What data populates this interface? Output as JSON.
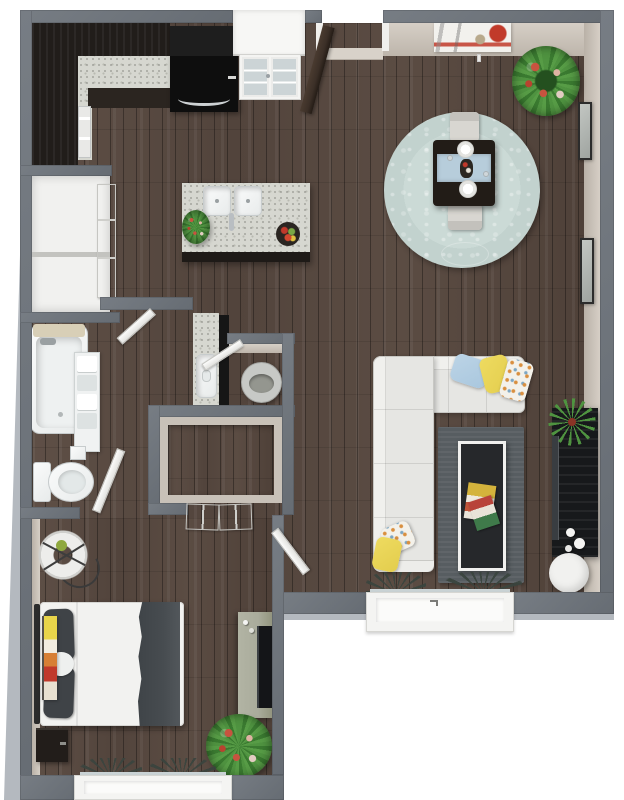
{
  "meta": {
    "description": "3D rendered top-down floor plan of a one-bedroom apartment with dark hardwood floors",
    "view": "top-down-3d-floorplan"
  },
  "palette": {
    "wood": "#55463e",
    "wall": "#666c73",
    "wall-hi": "#777d84",
    "wall-inner": "#d6cfc6",
    "wall-outer": "#b4b9bf",
    "cabinet": "#211d1a",
    "counter": "#d6d7d0",
    "stove": "#121212",
    "rug-red": "#7a3527",
    "rug-gold": "#b98f4e",
    "rug-field": "#c6d6d2",
    "table-dark": "#221c17",
    "glass-blue": "#b7cddb",
    "sofa": "#e6e6e3",
    "pillow-blue": "#a9c7de",
    "pillow-yellow": "#e3cd4d",
    "accent-orange": "#d98f3f",
    "rug-gray": "#575d61",
    "console": "#17191b",
    "plant": "#4f9340",
    "flower": "#c7533f",
    "bed-white": "#f2f2f0",
    "pillow-dark": "#3f4347",
    "blanket": "#474c50",
    "dresser": "#a9ab9b",
    "fixture-white": "#f4f6f6",
    "door-white": "#f0f0ee",
    "door-wood": "#3b2f27",
    "artwork-red": "#c13a2a"
  },
  "rooms": {
    "kitchen": {
      "label": "kitchen",
      "furniture": [
        "wall-cabinets",
        "countertop",
        "range",
        "dishwasher",
        "kitchen-island",
        "double-sink",
        "faucet",
        "herb-plant",
        "fruit-bowl",
        "french-door",
        "balcony-bay"
      ]
    },
    "dining": {
      "label": "dining-area",
      "furniture": [
        "round-area-rug",
        "dining-table",
        "glass-insert",
        "plate",
        "plate",
        "vase",
        "dining-chair",
        "dining-chair",
        "potted-plant",
        "abstract-wall-art",
        "pendant-light"
      ]
    },
    "living": {
      "label": "living-room",
      "furniture": [
        "sectional-sofa",
        "pillow-blue",
        "pillow-yellow",
        "pillow-patterned",
        "pillow-patterned",
        "pillow-yellow",
        "gray-area-rug",
        "coffee-table",
        "magazines",
        "media-console",
        "flat-tv",
        "spider-plant",
        "decor-spheres",
        "round-ottoman",
        "picture-window",
        "sill-plants"
      ]
    },
    "bathroom": {
      "label": "bathroom",
      "furniture": [
        "bathtub",
        "bath-mat",
        "towel-shelf",
        "tissue-box",
        "toilet",
        "vanity-counter",
        "vanity-sink",
        "mirror-cabinet",
        "laundry-basket"
      ]
    },
    "closets": {
      "label": "closets",
      "items": [
        "pantry-closet",
        "laundry-closet",
        "walk-in-closet",
        "closet-double-doors"
      ]
    },
    "bedroom": {
      "label": "bedroom",
      "furniture": [
        "queen-bed",
        "dark-pillows",
        "leaf-pillow",
        "duvet",
        "throw-blanket",
        "nightstand",
        "hanging-chair",
        "dresser",
        "flat-tv",
        "leaning-artwork",
        "potted-plant",
        "window",
        "sill-plants"
      ]
    },
    "entry": {
      "label": "entry",
      "furniture": [
        "entry-door",
        "threshold"
      ]
    }
  }
}
